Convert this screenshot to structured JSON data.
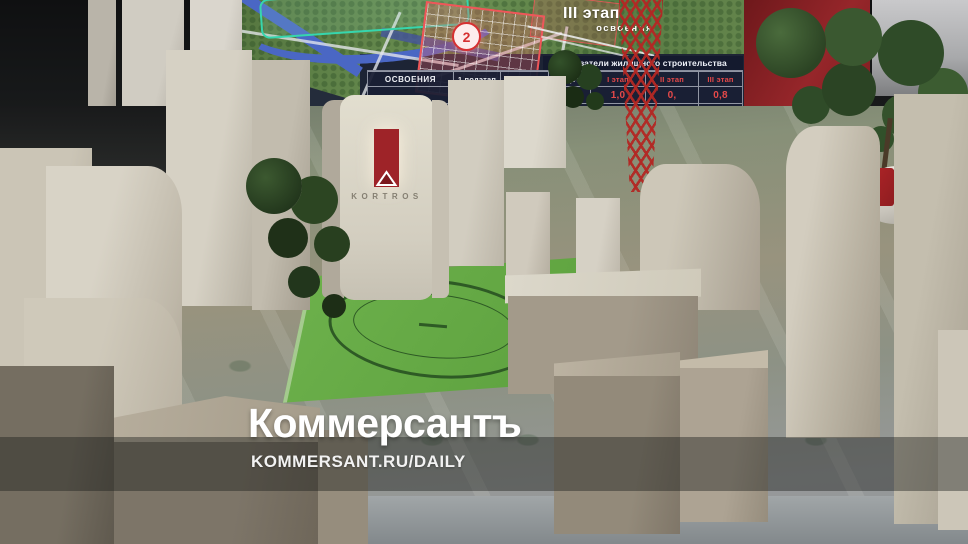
{
  "watermark": {
    "title": "Коммерсантъ",
    "url": "KOMMERSANT.RU/DAILY"
  },
  "screen": {
    "stage_label": "III этап",
    "stage_sublabel": "освоения",
    "district_badge": "2",
    "table": {
      "title": "Показатели жилищного строительства",
      "first_col_header": "освоения",
      "headers": [
        "1 подэтап",
        "2 подэтап",
        "3 подэтап",
        "I этап",
        "II этап",
        "III этап"
      ],
      "rows": [
        [
          "",
          "0,4",
          "",
          "",
          "1,0",
          "0,",
          "0,8"
        ],
        [
          "",
          "13,3",
          "",
          "",
          "34,1",
          "18,2",
          ""
        ]
      ]
    }
  },
  "model": {
    "brand": "KORTROS"
  },
  "colors": {
    "kortros_red": "#9e2328",
    "table_value_red": "#e64949",
    "badge_red": "#d63031",
    "field_green": "#67ab47",
    "watermark_white": "#ffffff"
  }
}
